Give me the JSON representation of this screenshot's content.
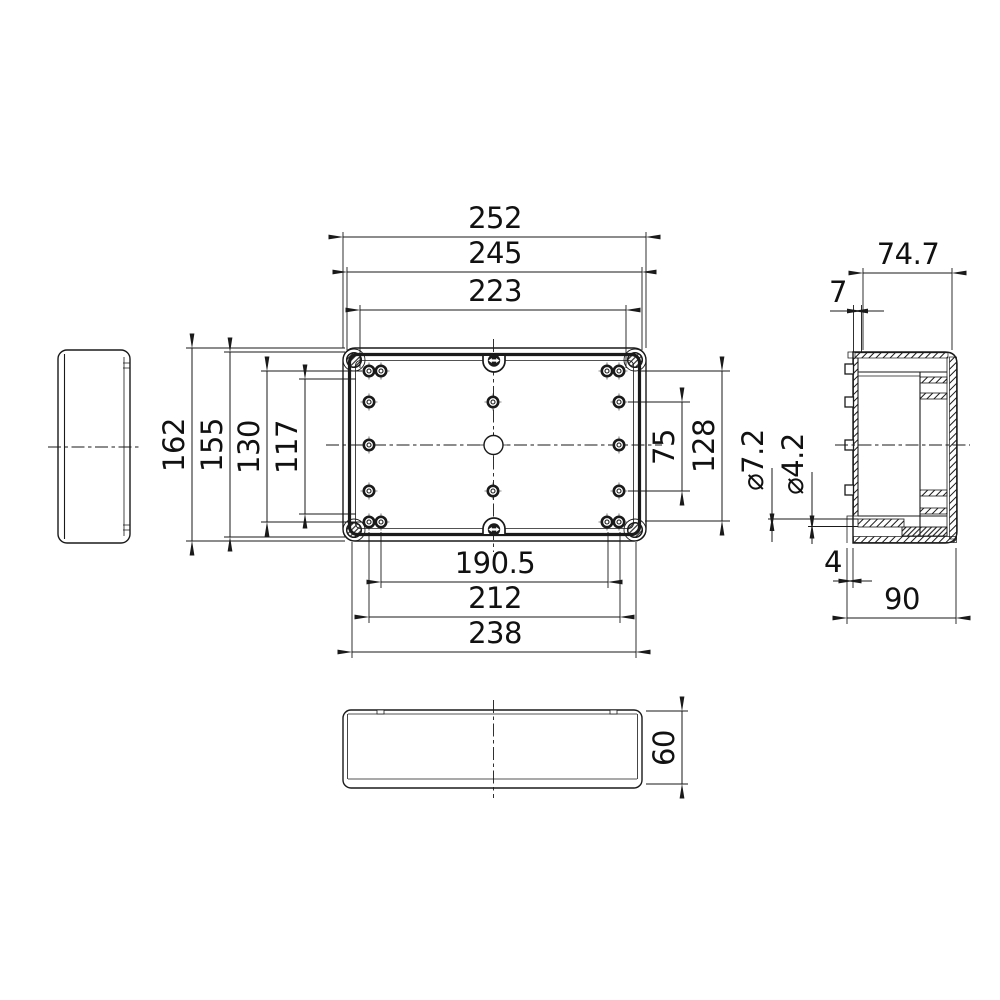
{
  "drawing": {
    "background_color": "#ffffff",
    "line_color": "#1a1a1a"
  },
  "dimensions": {
    "top": {
      "d252": "252",
      "d245": "245",
      "d223": "223"
    },
    "bottom": {
      "d190_5": "190.5",
      "d212": "212",
      "d238": "238"
    },
    "left": {
      "d162": "162",
      "d155": "155",
      "d130": "130",
      "d117": "117"
    },
    "right": {
      "d75": "75",
      "d128": "128"
    },
    "side": {
      "d74_7": "74.7",
      "d7": "7",
      "dia7_2": "⌀7.2",
      "dia4_2": "⌀4.2",
      "d4": "4",
      "d90": "90"
    },
    "front": {
      "d60": "60"
    }
  }
}
